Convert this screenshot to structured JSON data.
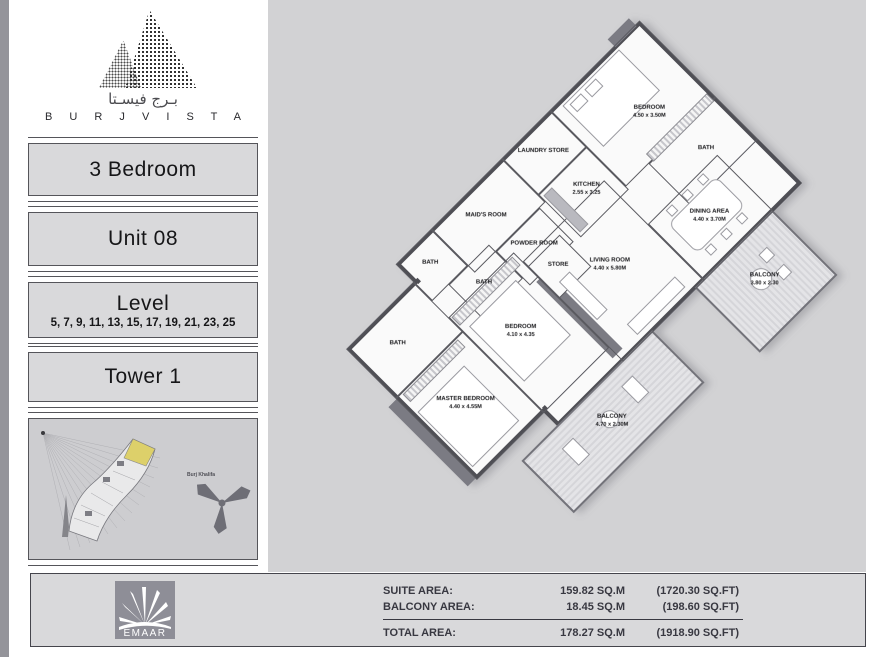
{
  "brand": {
    "arabic": "بـرج فيسـتا",
    "name": "B U R J   V I S T A"
  },
  "sidebar": {
    "panels": [
      {
        "title": "3 Bedroom",
        "subtitle": ""
      },
      {
        "title": "Unit 08",
        "subtitle": ""
      },
      {
        "title": "Level",
        "subtitle": "5, 7, 9, 11, 13, 15, 17, 19, 21, 23, 25"
      },
      {
        "title": "Tower 1",
        "subtitle": ""
      }
    ],
    "keyplan": {
      "landmark_label": "Burj Khalifa",
      "highlight_color": "#ddd06a"
    }
  },
  "plan": {
    "rooms": [
      {
        "name": "BATH",
        "dims": ""
      },
      {
        "name": "MAID'S ROOM",
        "dims": ""
      },
      {
        "name": "LAUNDRY STORE",
        "dims": ""
      },
      {
        "name": "KITCHEN",
        "dims": "2.55 x 3.25"
      },
      {
        "name": "BEDROOM",
        "dims": "4.50 x 3.50M"
      },
      {
        "name": "BATH",
        "dims": ""
      },
      {
        "name": "BATH",
        "dims": ""
      },
      {
        "name": "POWDER ROOM",
        "dims": ""
      },
      {
        "name": "BATH",
        "dims": ""
      },
      {
        "name": "MASTER BEDROOM",
        "dims": "4.40 x 4.55M"
      },
      {
        "name": "BEDROOM",
        "dims": "4.10 x 4.35"
      },
      {
        "name": "STORE",
        "dims": ""
      },
      {
        "name": "LIVING ROOM",
        "dims": "4.40 x 5.80M"
      },
      {
        "name": "DINING AREA",
        "dims": "4.40 x 3.70M"
      },
      {
        "name": "BALCONY",
        "dims": "4.70 x 2.30M"
      },
      {
        "name": "BALCONY",
        "dims": "3.80 x 2.30"
      }
    ]
  },
  "footer": {
    "logo_text": "EMAAR",
    "rows": [
      {
        "label": "SUITE AREA:",
        "value": "159.82 SQ.M",
        "paren": "(1720.30 SQ.FT)"
      },
      {
        "label": "BALCONY AREA:",
        "value": "18.45 SQ.M",
        "paren": "(198.60 SQ.FT)"
      }
    ],
    "total": {
      "label": "TOTAL AREA:",
      "value": "178.27 SQ.M",
      "paren": "(1918.90 SQ.FT)"
    }
  },
  "colors": {
    "main_bg": "#d2d2d4",
    "panel_bg": "#d9d9db",
    "wall": "#4f4f55",
    "highlight_yellow": "#ddd06a",
    "landmark_gray": "#6e6e76"
  }
}
